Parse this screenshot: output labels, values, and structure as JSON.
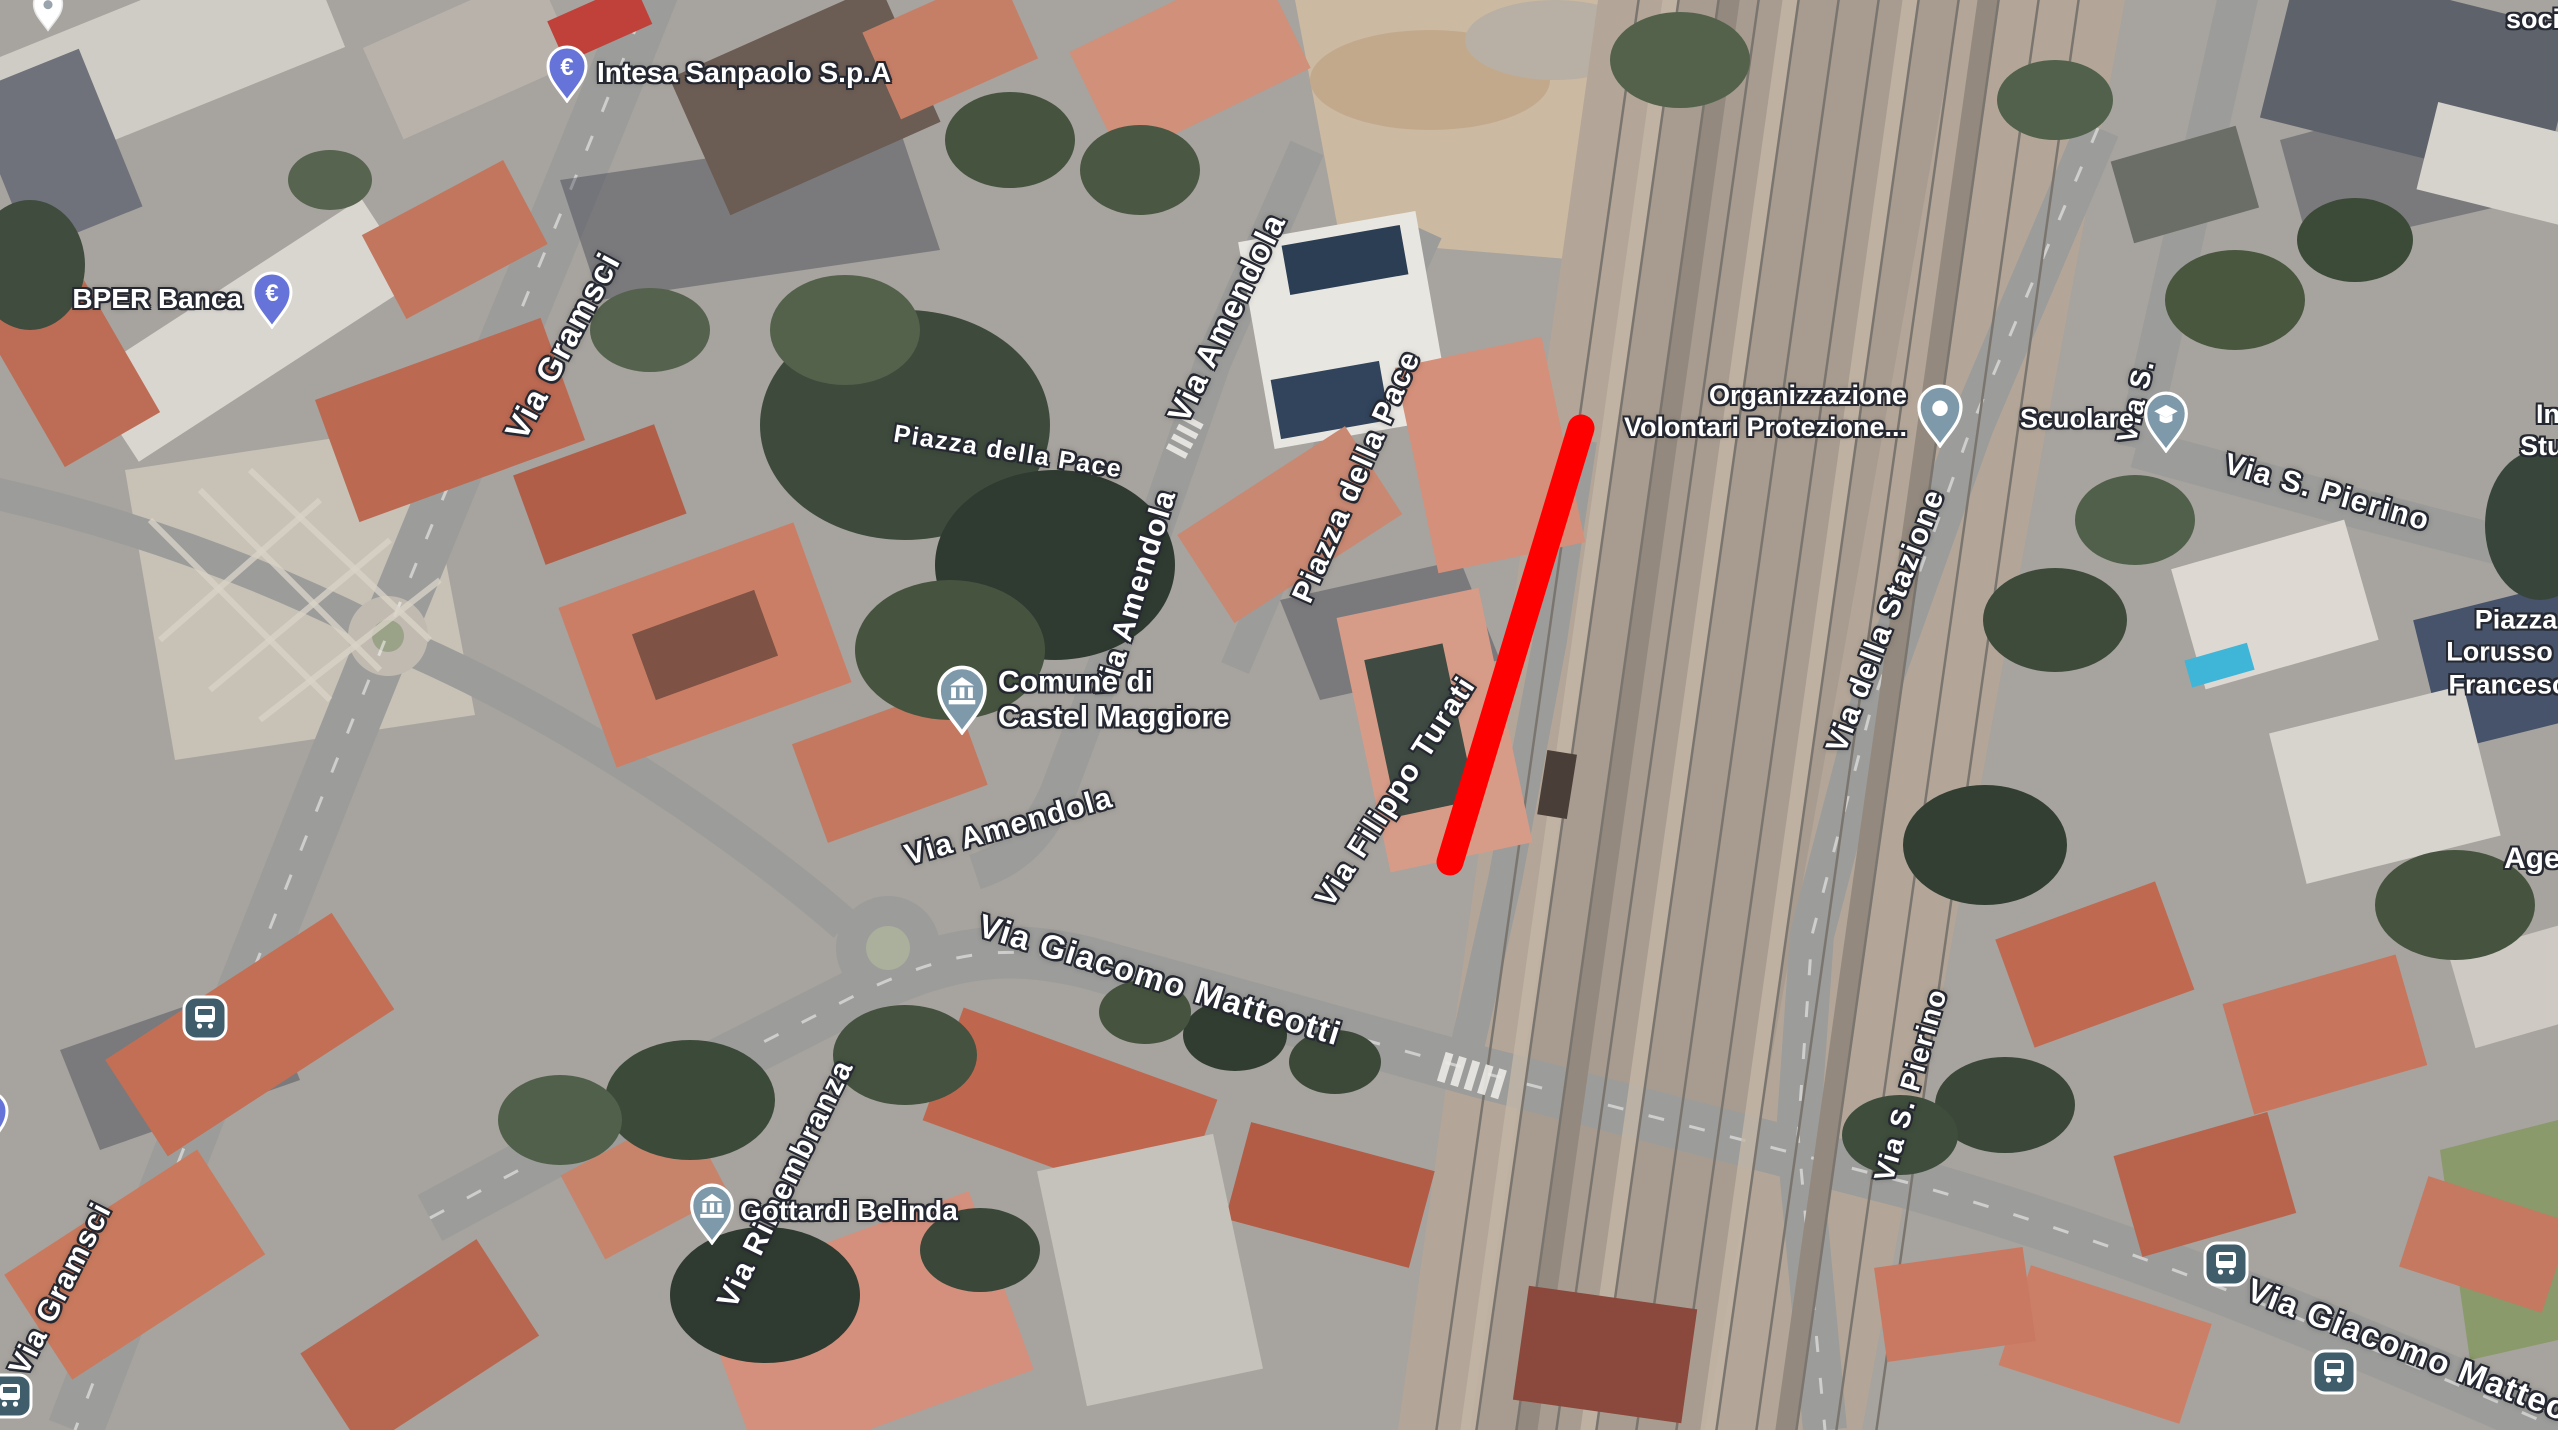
{
  "map": {
    "annotation": {
      "type": "line",
      "color": "#ff0000",
      "x1": 1581,
      "y1": 428,
      "x2": 1450,
      "y2": 862,
      "stroke_width": 27
    },
    "icons": {
      "euro": "€"
    },
    "colors": {
      "bank_pin": "#6673d8",
      "civic_pin": "#7e99aa",
      "transit_icon": "#3f5d6b",
      "label_text": "#ffffff",
      "label_halo": "#252831",
      "annotation": "#ff0000"
    },
    "street_labels": [
      {
        "id": "via-gramsci-north",
        "text": "Via Gramsci"
      },
      {
        "id": "piazza-della-pace-west",
        "text": "Piazza della Pace"
      },
      {
        "id": "via-amendola-north",
        "text": "Via Amendola"
      },
      {
        "id": "piazza-della-pace-east",
        "text": "Piazza della Pace"
      },
      {
        "id": "via-amendola-mid",
        "text": "Via Amendola"
      },
      {
        "id": "via-amendola-south",
        "text": "Via Amendola"
      },
      {
        "id": "via-filippo-turati",
        "text": "Via Filippo Turati"
      },
      {
        "id": "via-giacomo-matteotti",
        "text": "Via Giacomo Matteotti"
      },
      {
        "id": "via-della-stazione",
        "text": "Via della Stazione"
      },
      {
        "id": "via-s-partial",
        "text": "Via S."
      },
      {
        "id": "via-s-pierino-upper",
        "text": "Via S. Pierino"
      },
      {
        "id": "via-s-pierino-lower",
        "text": "Via S. Pierino"
      },
      {
        "id": "via-rimembranza",
        "text": "Via Rimembranza"
      },
      {
        "id": "via-gramsci-south",
        "text": "Via Gramsci"
      },
      {
        "id": "via-giacomo-matteotti-southeast",
        "text": "Via Giacomo Matteo"
      }
    ],
    "pois": [
      {
        "id": "intesa-sanpaolo",
        "label": "Intesa Sanpaolo S.p.A",
        "icon": "euro-bank-pin"
      },
      {
        "id": "bper-banca",
        "label": "BPER Banca",
        "icon": "euro-bank-pin"
      },
      {
        "id": "comune-castel-maggiore",
        "lines": [
          "Comune di",
          "Castel Maggiore"
        ],
        "icon": "civic-building-pin"
      },
      {
        "id": "organizzazione-volontari",
        "lines": [
          "Organizzazione",
          "Volontari Protezione..."
        ],
        "icon": "dot-pin"
      },
      {
        "id": "scuolare",
        "label": "Scuolare",
        "icon": "school-pin"
      },
      {
        "id": "gottardi-belinda",
        "label": "Gottardi Belinda",
        "icon": "civic-building-pin"
      },
      {
        "id": "piazza-lorusso",
        "lines": [
          "Piazza",
          "Lorusso Pi",
          "Francesco"
        ]
      },
      {
        "id": "edge-label-socia",
        "label": "socia"
      },
      {
        "id": "edge-label-in-stud",
        "lines": [
          "In",
          "Stud"
        ]
      },
      {
        "id": "edge-label-agen",
        "label": "Agen"
      }
    ],
    "transit_stops": [
      {
        "id": "bus-stop-gramsci-north"
      },
      {
        "id": "bus-stop-gramsci-south"
      },
      {
        "id": "bus-stop-matteotti-west"
      },
      {
        "id": "bus-stop-matteotti-east"
      }
    ]
  }
}
